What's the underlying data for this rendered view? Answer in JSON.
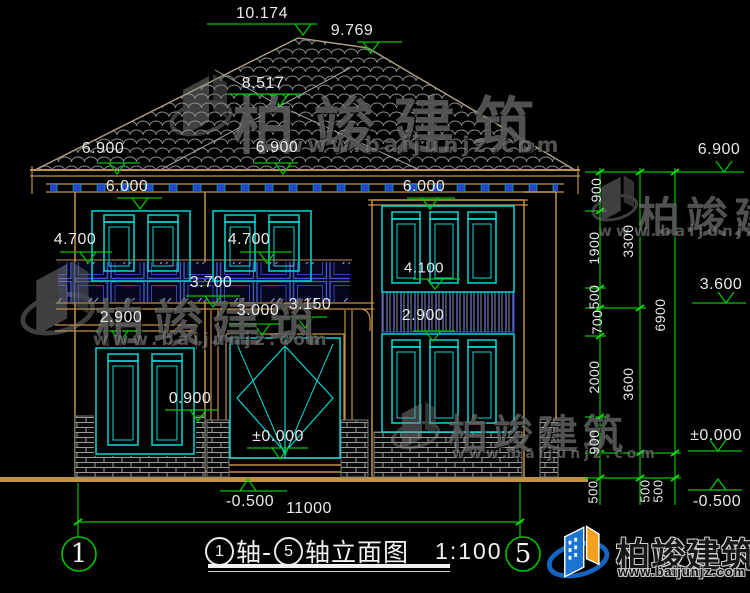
{
  "drawing": {
    "annotations": {
      "elevations": {
        "ridge": "10.174",
        "hip_right": "9.769",
        "hip_mid": "8.517",
        "eave_left": "6.900",
        "eave_mid": "6.900",
        "eave_right": "6.900",
        "six_left": "6.000",
        "six_right": "6.000",
        "four7_left": "4.700",
        "four7_mid": "4.700",
        "four1": "4.100",
        "three7": "3.700",
        "three6_right": "3.600",
        "three15": "3.150",
        "three0": "3.000",
        "two9_left": "2.900",
        "two9_right": "2.900",
        "zero9": "0.900",
        "zero_center": "±0.000",
        "zero_right": "±0.000",
        "minus05_center": "-0.500",
        "minus05_right": "-0.500"
      },
      "dims": {
        "total_width": "11000",
        "chain_inner": [
          "900",
          "1900",
          "500",
          "700",
          "2000",
          "900",
          "500"
        ],
        "chain_mid": [
          "3300",
          "3600",
          "500"
        ],
        "chain_outer": [
          "6900",
          "500"
        ]
      },
      "bubbles": {
        "left": "1",
        "right": "5"
      }
    },
    "titlebar": {
      "bubble1": "1",
      "mid": "轴-",
      "bubble2": "5",
      "rest": "轴立面图",
      "scale": "1:100"
    }
  },
  "watermark": {
    "brand": "柏竣建筑",
    "url": "www.baijunjz.com"
  },
  "logo": {
    "brand": "柏竣建筑",
    "url": "www.baijunjz.com"
  },
  "colors": {
    "background": "#000000",
    "dimension_green": "#00c400",
    "window_cyan": "#00d8d8",
    "trim_tan": "#c29343",
    "glass_blue": "#4153cc",
    "text_white": "#e9e9e9",
    "logo_blue": "#1b74d1",
    "logo_orange": "#f5a01e"
  }
}
